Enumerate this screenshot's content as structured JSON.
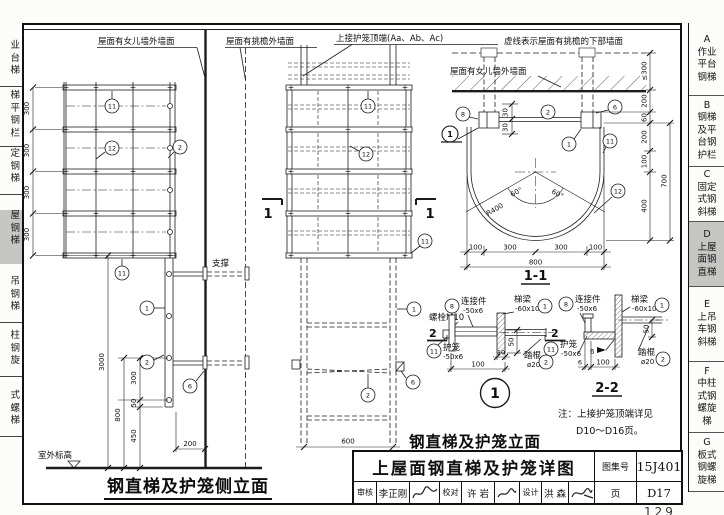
{
  "tabs_left": {
    "items": [
      {
        "text": "业\n台\n梯"
      },
      {
        "text": "梯\n平\n钢\n栏"
      },
      {
        "text": "定\n钢\n梯"
      },
      {
        "text": "屋\n钢\n梯"
      },
      {
        "text": "吊\n钢\n梯"
      },
      {
        "text": "柱\n钢\n旋"
      },
      {
        "text": "式\n螺\n梯"
      }
    ]
  },
  "sidebar": {
    "items": [
      {
        "key": "A",
        "text": "A\n作业\n平台\n钢梯"
      },
      {
        "key": "B",
        "text": "B\n钢梯\n及平\n台钢\n护栏"
      },
      {
        "key": "C",
        "text": "C\n固定\n式钢\n斜梯"
      },
      {
        "key": "D",
        "text": "D\n上屋\n面钢\n直梯"
      },
      {
        "key": "E",
        "text": "E\n上吊\n车钢\n斜梯"
      },
      {
        "key": "F",
        "text": "F\n中柱\n式钢\n螺旋\n梯"
      },
      {
        "key": "G",
        "text": "G\n板式\n钢螺\n旋梯"
      }
    ]
  },
  "t": {
    "parapet": "屋面有女儿墙外墙面",
    "eave": "屋面有挑檐外墙面",
    "cagetop": "上接护笼顶端(Aa、Ab、Ac)",
    "dashednote": "虚线表示屋面有挑檐的下部墙面",
    "support": "支撑",
    "level": "室外标高",
    "d300": "300",
    "d3000": "3000",
    "d800": "800",
    "d50": "50",
    "d450": "450",
    "d200": "200",
    "d600": "600",
    "d100": "100",
    "d400": "400",
    "d700": "700",
    "d60": "60",
    "d30": "30",
    "d10": "10",
    "d6": "6",
    "le300": "≤300",
    "r400": "R400",
    "a60": "60°",
    "s11": "1-1",
    "s22": "2-2",
    "cut2": "2",
    "conn": "连接件",
    "p506": "-50x6",
    "beam": "梯梁",
    "p6010": "-60x10",
    "bolt": "螺栓M10",
    "cage": "护笼",
    "rung": "踏棍",
    "phi20": "ø20",
    "n1": "1",
    "n2": "2",
    "n6": "6",
    "n8": "8",
    "n11": "11",
    "n12": "12",
    "note1": "注：上接护笼顶端详见",
    "note2": "D10～D16页。",
    "sidetitle": "钢直梯及护笼侧立面",
    "fronttitle": "钢直梯及护笼立面"
  },
  "title_block": {
    "main_title": "上屋面钢直梯及护笼详图",
    "atlas_label": "图集号",
    "atlas_no": "15J401",
    "page_label": "页",
    "page_no": "D17",
    "review_label": "审核",
    "review_name": "李正刚",
    "proof_label": "校对",
    "proof_name": "许 岩",
    "design_label": "设计",
    "design_name": "洪 森"
  },
  "page_number": "129"
}
